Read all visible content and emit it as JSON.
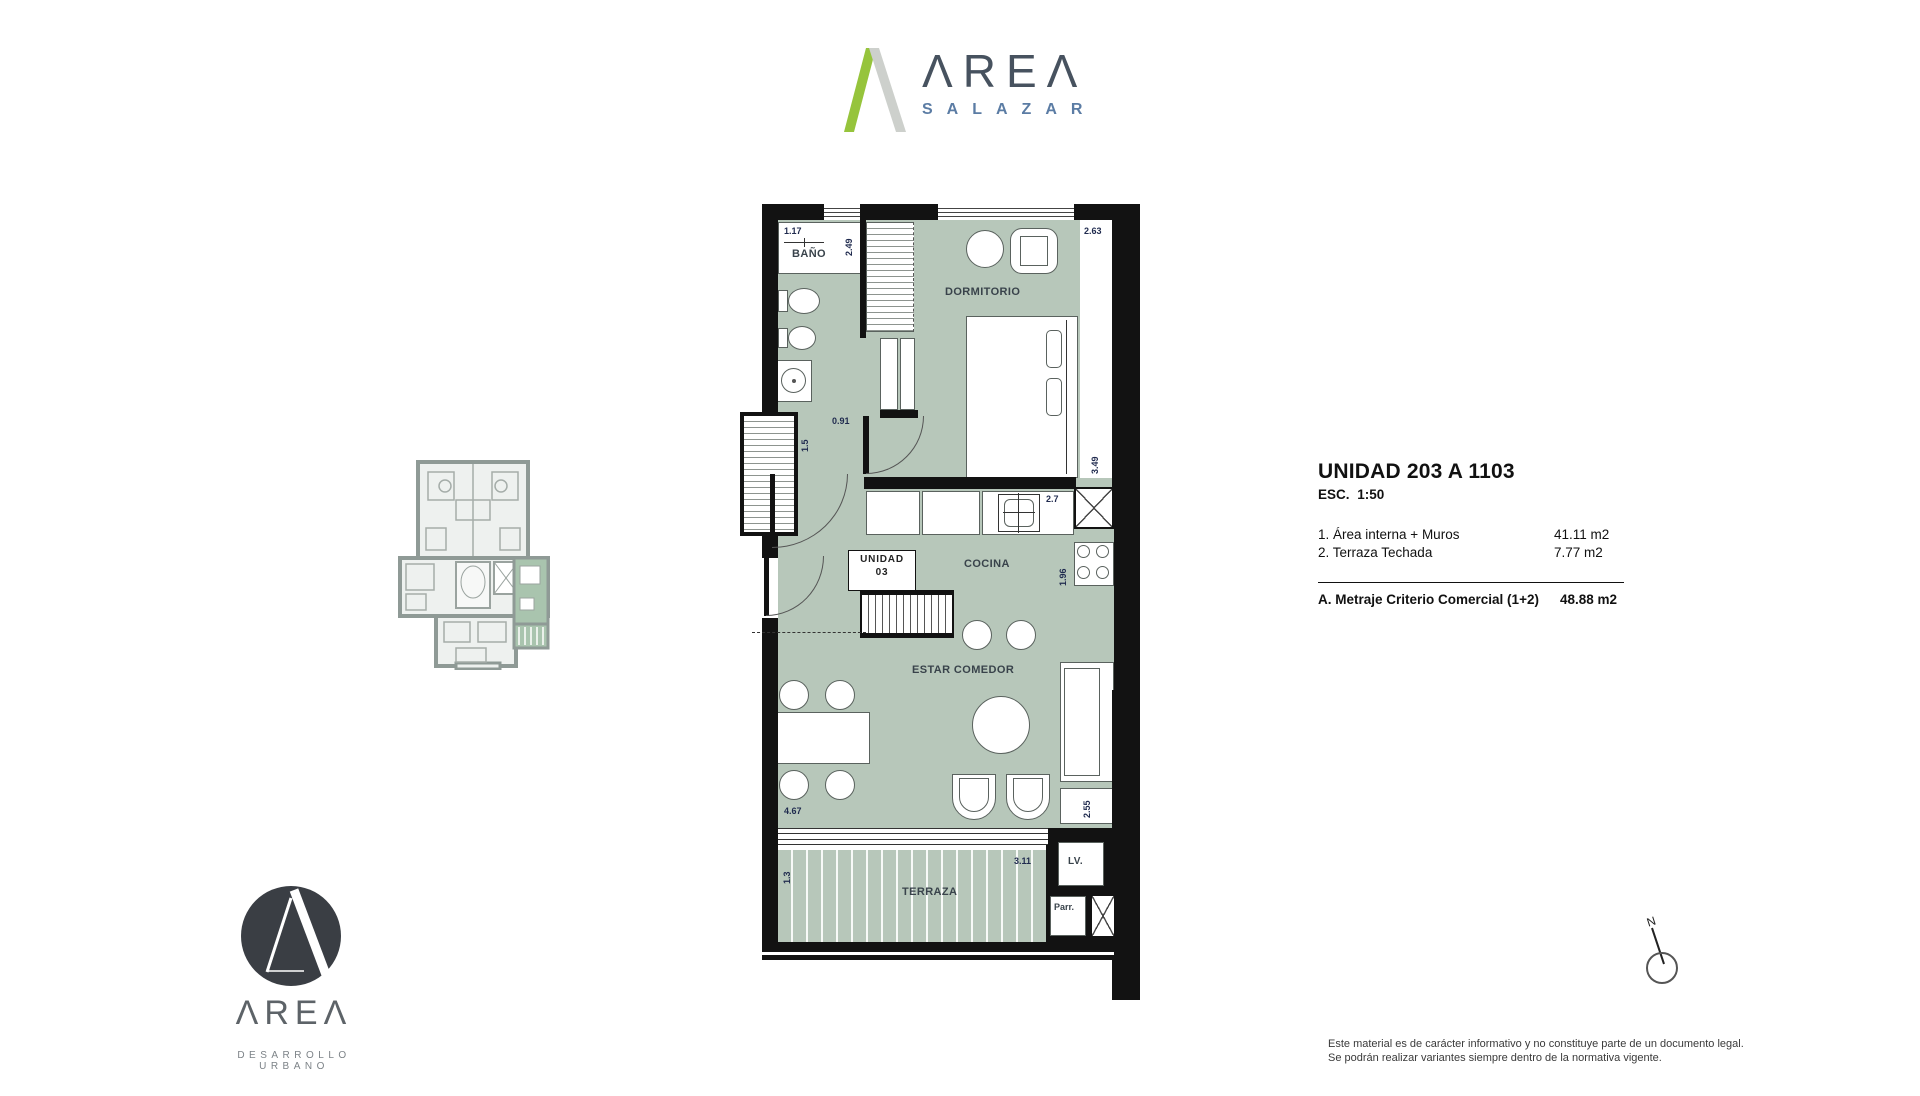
{
  "header_logo": {
    "word": "ΛREΛ",
    "sub": "SALAZAR"
  },
  "unit_info": {
    "title": "UNIDAD 203 A 1103",
    "scale": "ESC.  1:50",
    "items": [
      {
        "label": "1. Área interna + Muros",
        "value": "41.11 m2"
      },
      {
        "label": "2. Terraza Techada",
        "value": "7.77 m2"
      }
    ],
    "total_label": "A. Metraje Criterio Comercial (1+2)",
    "total_value": "48.88 m2"
  },
  "plan": {
    "rooms": {
      "bano": "BAÑO",
      "dormitorio": "DORMITORIO",
      "cocina": "COCINA",
      "estar": "ESTAR COMEDOR",
      "terraza": "TERRAZA",
      "lavanderia": "LV.",
      "parrilla": "Parr."
    },
    "unit_tag": {
      "line1": "UNIDAD",
      "line2": "03"
    },
    "dims": {
      "bano_width": "1.17",
      "bano_depth": "2.49",
      "dorm_width": "2.63",
      "dorm_depth": "3.49",
      "pasillo": "1.5",
      "puerta": "0.91",
      "cocina_len": "2.7",
      "cocina_depth": "1.96",
      "estar_width": "4.67",
      "estar_depth": "2.55",
      "terraza_depth": "1.3",
      "terraza_len": "3.11"
    }
  },
  "compass": {
    "north": "N"
  },
  "footer_logo": {
    "word": "ΛREΛ",
    "tagline": "DESARROLLO URBANO"
  },
  "disclaimer": {
    "line1": "Este material es de carácter informativo y no constituye parte de un documento legal.",
    "line2": "Se podrán realizar variantes siempre dentro de la normativa vigente."
  },
  "colors": {
    "room_fill": "#b7c7ba",
    "accent_green": "#96c43c",
    "brand_dark": "#47525f",
    "salazar_blue": "#5b7ca4",
    "wall": "#121212",
    "keyplan_grey": "#8f9a96"
  }
}
